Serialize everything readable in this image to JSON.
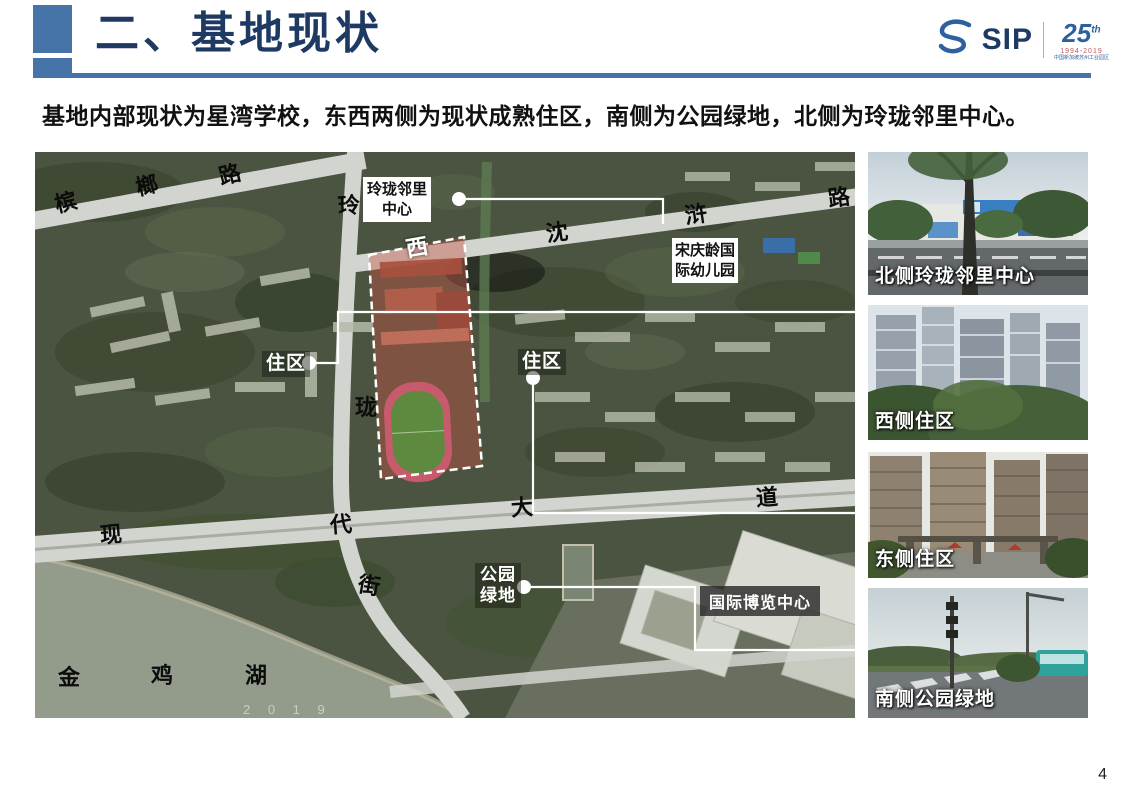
{
  "slide": {
    "title": "二、基地现状",
    "intro": "基地内部现状为星湾学校，东西两侧为现状成熟住区，南侧为公园绿地，北侧为玲珑邻里中心。",
    "page_number": "4"
  },
  "colors": {
    "accent_blue": "#4673a8",
    "title_navy": "#1e3a63",
    "site_overlay_red": "#c65442",
    "callout_white": "#ffffff"
  },
  "logo": {
    "icon": "sip-swirl-icon",
    "sip_text": "SIP",
    "anniversary_number": "25",
    "anniversary_sup": "th",
    "years": "1994-2019",
    "micro_text": "中国新加坡苏州工业园区"
  },
  "map": {
    "road_labels": [
      {
        "text": "槟"
      },
      {
        "text": "榔"
      },
      {
        "text": "路"
      },
      {
        "text": "玲"
      },
      {
        "text": "西"
      },
      {
        "text": "沈"
      },
      {
        "text": "浒"
      },
      {
        "text": "路"
      },
      {
        "text": "珑"
      },
      {
        "text": "现"
      },
      {
        "text": "代"
      },
      {
        "text": "大"
      },
      {
        "text": "道"
      },
      {
        "text": "街"
      },
      {
        "text": "金"
      },
      {
        "text": "鸡"
      },
      {
        "text": "湖"
      }
    ],
    "callouts": [
      {
        "text": "玲珑邻里中心",
        "style": "white-box"
      },
      {
        "text": "宋庆龄国际幼儿园",
        "style": "white-box"
      },
      {
        "text": "住区",
        "style": "white-text"
      },
      {
        "text": "住区",
        "style": "white-text"
      },
      {
        "text": "公园绿地",
        "style": "white-text"
      },
      {
        "text": "国际博览中心",
        "style": "dark-box"
      }
    ],
    "watermark": "2 0 1 9"
  },
  "photos": [
    {
      "caption": "北侧玲珑邻里中心"
    },
    {
      "caption": "西侧住区"
    },
    {
      "caption": "东侧住区"
    },
    {
      "caption": "南侧公园绿地"
    }
  ]
}
